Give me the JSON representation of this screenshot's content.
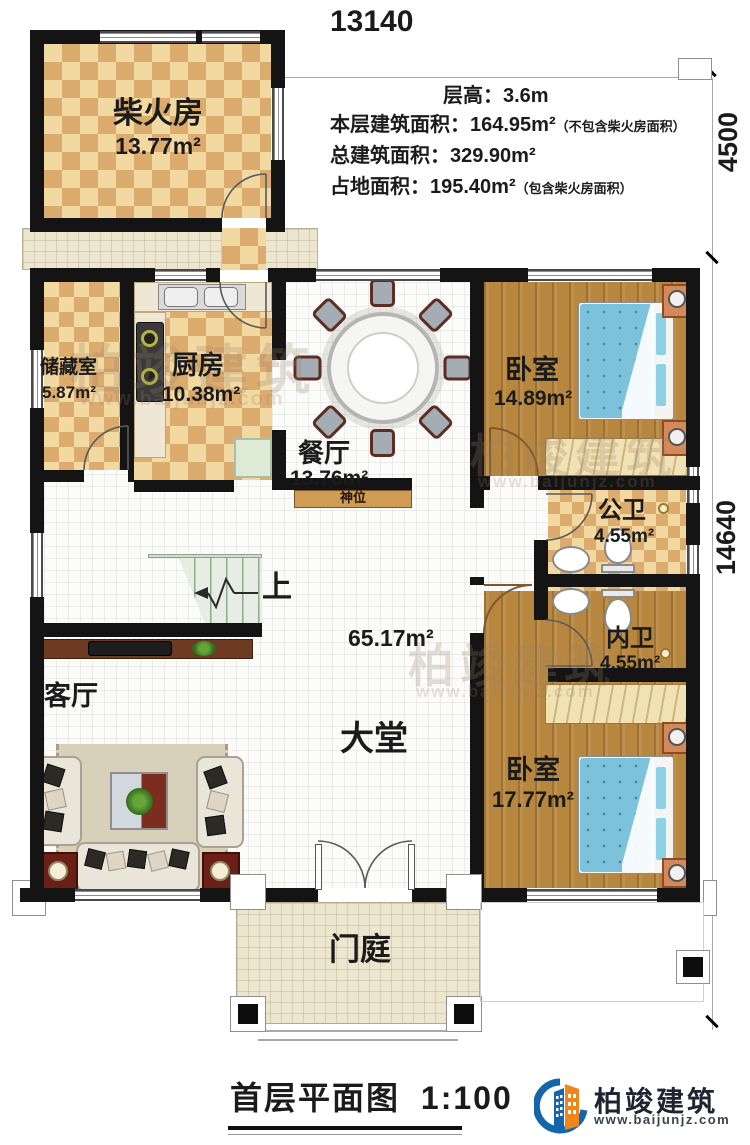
{
  "plan": {
    "title": "首层平面图",
    "scale": "1:100",
    "dimensions": {
      "width_top": "13140",
      "right_upper": "4500",
      "right_lower": "14640"
    },
    "info_lines": [
      {
        "label": "层高：",
        "value": "3.6m",
        "note": ""
      },
      {
        "label": "本层建筑面积：",
        "value": "164.95m²",
        "note": "（不包含柴火房面积）"
      },
      {
        "label": "总建筑面积：",
        "value": "329.90m²",
        "note": ""
      },
      {
        "label": "占地面积：",
        "value": "195.40m²",
        "note": "（包含柴火房面积）"
      }
    ],
    "rooms": [
      {
        "name": "柴火房",
        "area": "13.77m²"
      },
      {
        "name": "储藏室",
        "area": "5.87m²"
      },
      {
        "name": "厨房",
        "area": "10.38m²"
      },
      {
        "name": "餐厅",
        "area": "13.76m²"
      },
      {
        "name": "卧室",
        "area": "14.89m²"
      },
      {
        "name": "公卫",
        "area": "4.55m²"
      },
      {
        "name": "内卫",
        "area": "4.55m²"
      },
      {
        "name": "卧室",
        "area": "17.77m²"
      },
      {
        "name": "客厅",
        "area": ""
      },
      {
        "name": "大堂",
        "area": "65.17m²"
      },
      {
        "name": "门庭",
        "area": ""
      }
    ],
    "annotations": {
      "stairs_up": "上",
      "shrine": "神位"
    },
    "watermark": {
      "text": "柏竣建筑",
      "url": "www.baijunjz.com"
    },
    "logo": {
      "text": "柏竣建筑",
      "url": "www.baijunjz.com"
    }
  }
}
